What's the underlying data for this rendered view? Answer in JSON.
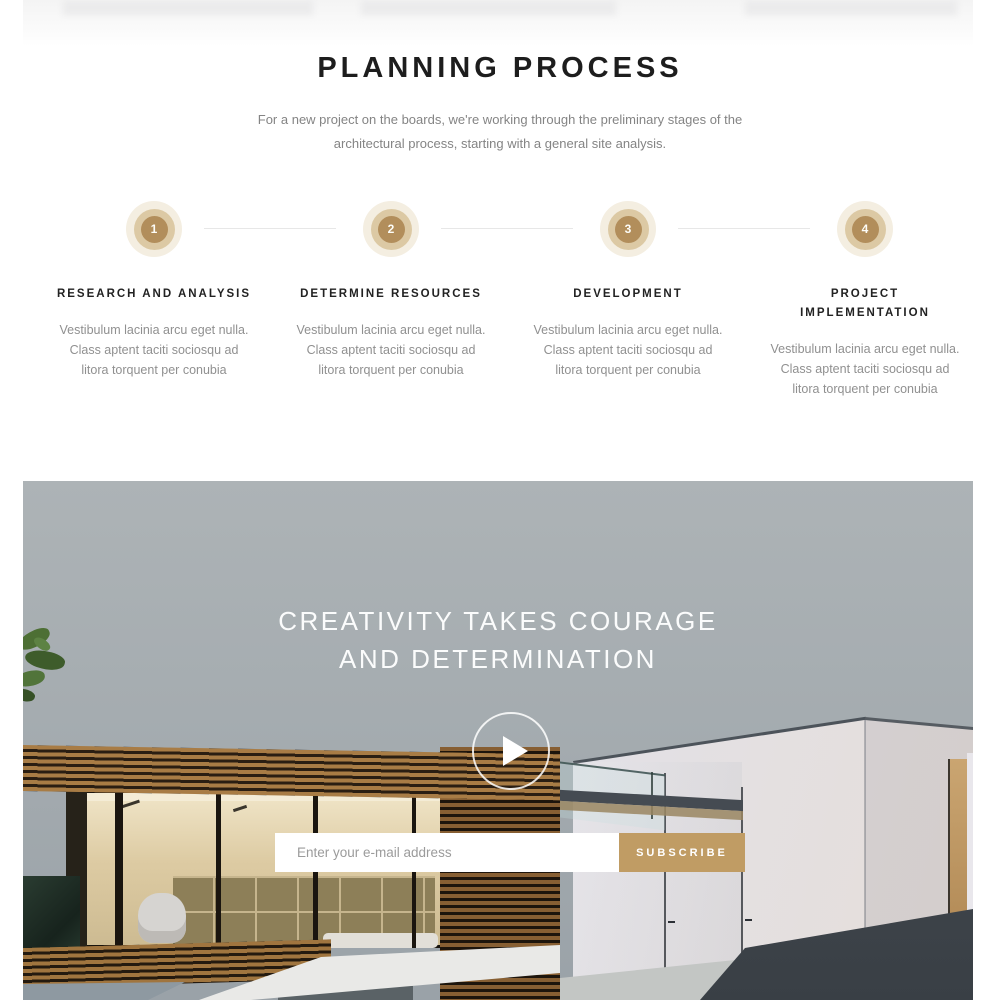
{
  "theme": {
    "accent_gold": "#c09c64",
    "circle_inner": "#b28e5b",
    "circle_mid": "#dcc9a4",
    "circle_outer": "#f4eee1",
    "connector_gray": "#e7e7e7",
    "sky_gray": "#a5acb0"
  },
  "planning": {
    "title": "PLANNING PROCESS",
    "subtitle_lines": [
      "For a new project on the boards, we're working through the preliminary stages of the",
      "architectural process, starting with a general site analysis."
    ],
    "steps": [
      {
        "number": "1",
        "title_lines": [
          "RESEARCH AND ANALYSIS",
          ""
        ],
        "body_lines": [
          "Vestibulum lacinia arcu eget nulla.",
          "Class aptent taciti sociosqu ad",
          "litora torquent per conubia"
        ]
      },
      {
        "number": "2",
        "title_lines": [
          "DETERMINE RESOURCES",
          ""
        ],
        "body_lines": [
          "Vestibulum lacinia arcu eget nulla.",
          "Class aptent taciti sociosqu ad",
          "litora torquent per conubia"
        ]
      },
      {
        "number": "3",
        "title_lines": [
          "DEVELOPMENT",
          ""
        ],
        "body_lines": [
          "Vestibulum lacinia arcu eget nulla.",
          "Class aptent taciti sociosqu ad",
          "litora torquent per conubia"
        ]
      },
      {
        "number": "4",
        "title_lines": [
          "PROJECT",
          "IMPLEMENTATION"
        ],
        "body_lines": [
          "Vestibulum lacinia arcu eget nulla.",
          "Class aptent taciti sociosqu ad",
          "litora torquent per conubia"
        ]
      }
    ]
  },
  "hero": {
    "heading_lines": [
      "CREATIVITY TAKES COURAGE",
      "AND DETERMINATION"
    ],
    "play_icon": "play-icon",
    "newsletter": {
      "placeholder": "Enter your e-mail address",
      "button_label": "SUBSCRIBE"
    }
  }
}
